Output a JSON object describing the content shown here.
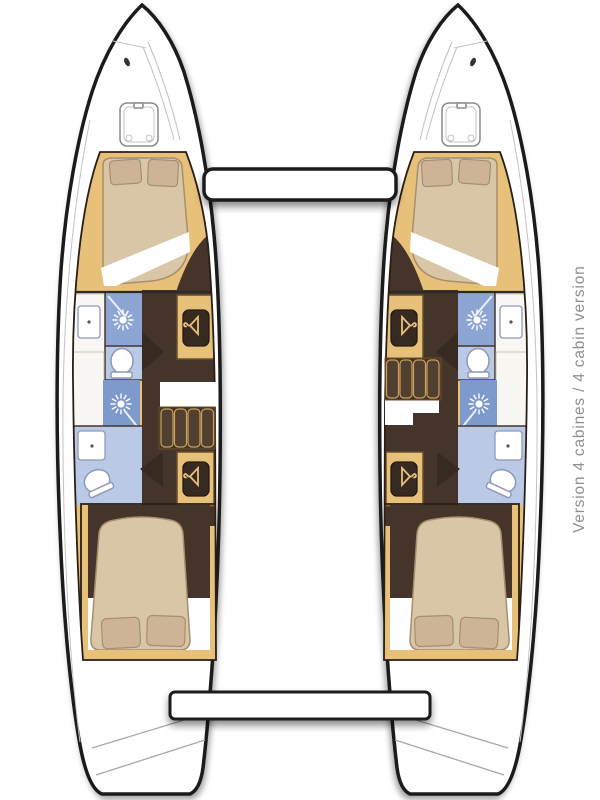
{
  "caption": {
    "text": "Version 4 cabines / 4 cabin version"
  },
  "floor_plan": {
    "type": "catamaran-deck-plan",
    "view": "top-down",
    "configuration": "4 cabins / 4 shower-heads, two symmetric hulls joined by forward crossbeam and aft cockpit step",
    "hulls": [
      {
        "side": "port-left",
        "spaces_bow_to_stern": [
          "bow deck with hatch",
          "forward double cabin: island berth with two pillows",
          "forward head: washbasin counter, shower stall with rose, toilet",
          "hanging wardrobe (hanger icon)",
          "companionway stairs with landing",
          "aft shower stall with rose",
          "aft head: washbasin, toilet",
          "hanging wardrobe (hanger icon)",
          "aft double cabin: tapered berth with two pillows",
          "transom swim steps"
        ]
      },
      {
        "side": "starboard-right",
        "spaces_bow_to_stern": [
          "bow deck with hatch",
          "forward double cabin: island berth with two pillows",
          "forward head: washbasin counter, shower stall with rose, toilet",
          "hanging wardrobe (hanger icon)",
          "companionway stairs with landing",
          "aft shower stall with rose",
          "aft head: washbasin, toilet",
          "hanging wardrobe (hanger icon)",
          "aft double cabin: tapered berth with two pillows",
          "transom swim steps"
        ]
      }
    ],
    "center_structures": [
      "forward crossbeam",
      "aft cockpit step platform"
    ]
  },
  "icons": [
    {
      "name": "shower-rose-icon",
      "meaning": "shower head"
    },
    {
      "name": "hanger-icon",
      "meaning": "hanging wardrobe"
    },
    {
      "name": "deck-hatch-icon",
      "meaning": "deck hatch"
    },
    {
      "name": "toilet",
      "meaning": "marine toilet"
    },
    {
      "name": "sink",
      "meaning": "washbasin"
    }
  ],
  "colors": {
    "white": "#ffffff",
    "outline": "#1b1b1b",
    "wood": "#e7c17a",
    "woodline": "#caa05c",
    "woodborder": "#6b4e28",
    "bed": "#d9c6a6",
    "bedline": "#a78f6d",
    "pillow": "#cdb496",
    "floor": "#44342a",
    "door": "#372a21",
    "shower": "#8ca5d3",
    "shower2": "#7e99cc",
    "bath": "#bac9e6",
    "fixture": "#8d99b5",
    "counter": "#f8f7f3",
    "counterline": "#c9c3b6",
    "deckline": "#c2c2c2",
    "captioncolor": "#8f8f8f"
  }
}
